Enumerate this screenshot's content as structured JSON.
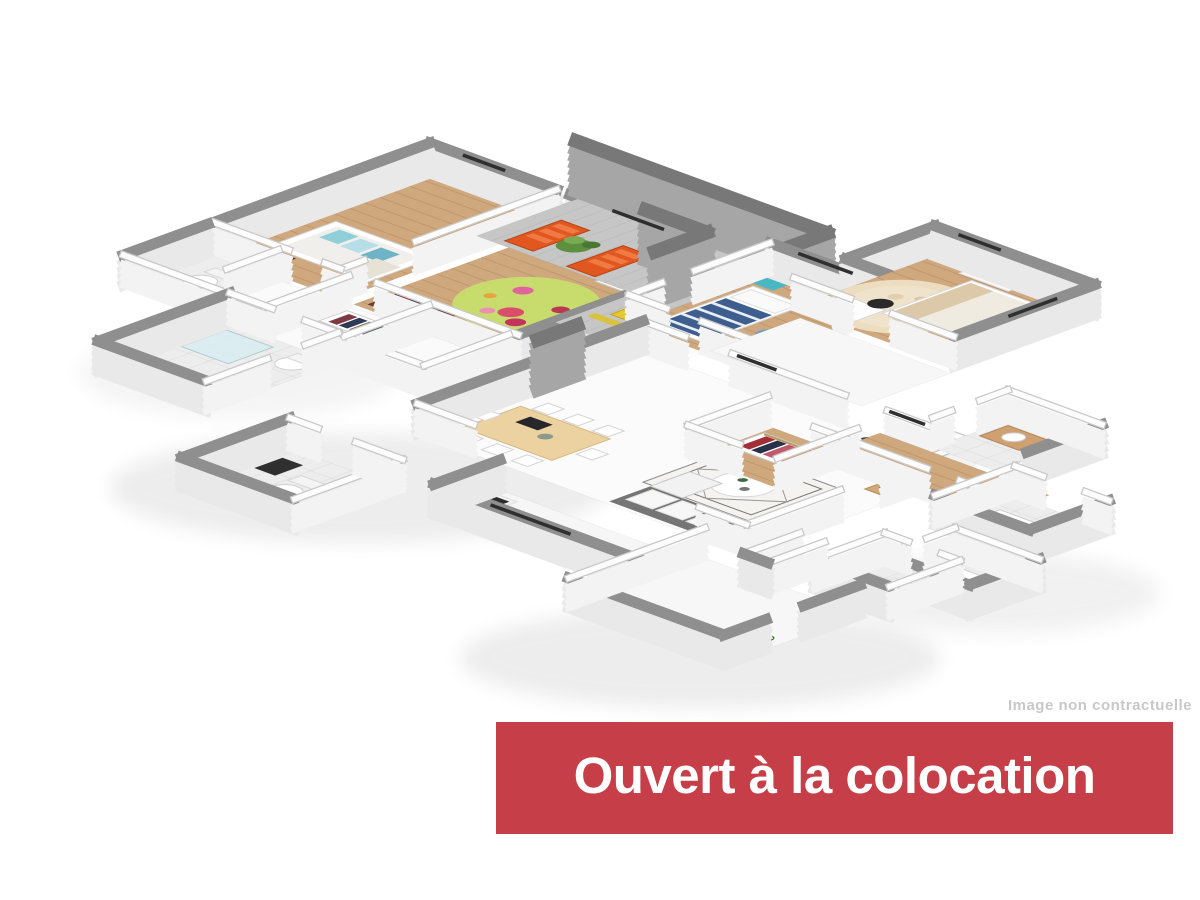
{
  "page": {
    "background": "#ffffff"
  },
  "floorplan": {
    "description": "isometric 3d apartment floor plan",
    "colors": {
      "exterior_wall": "#8f8f8f",
      "interior_wall": "#fdfdfd",
      "interior_wall_edge": "#c9c9c9",
      "wall_face": "#e9e9e9",
      "tall_wall": "#787878",
      "tall_wall_face": "#a6a6a6",
      "wood_floor": "#cfa87e",
      "tile_floor": "#ededed",
      "white_floor": "#fafafa",
      "terrace_floor": "#c6c6c6",
      "rug_green": "#c8dc6e",
      "rug_beige": "#ecdcc0",
      "lounger_orange": "#e2571f",
      "bed_blue": "#3d5e8f",
      "accent_teal": "#49b8c4",
      "furniture_wood": "#ecd2a0",
      "shadow": "#d9d9d9"
    }
  },
  "disclaimer": {
    "text": "Image non contractuelle",
    "color": "#c8c8c8"
  },
  "banner": {
    "label": "Ouvert à la colocation",
    "background": "#c63e47",
    "text_color": "#ffffff"
  }
}
